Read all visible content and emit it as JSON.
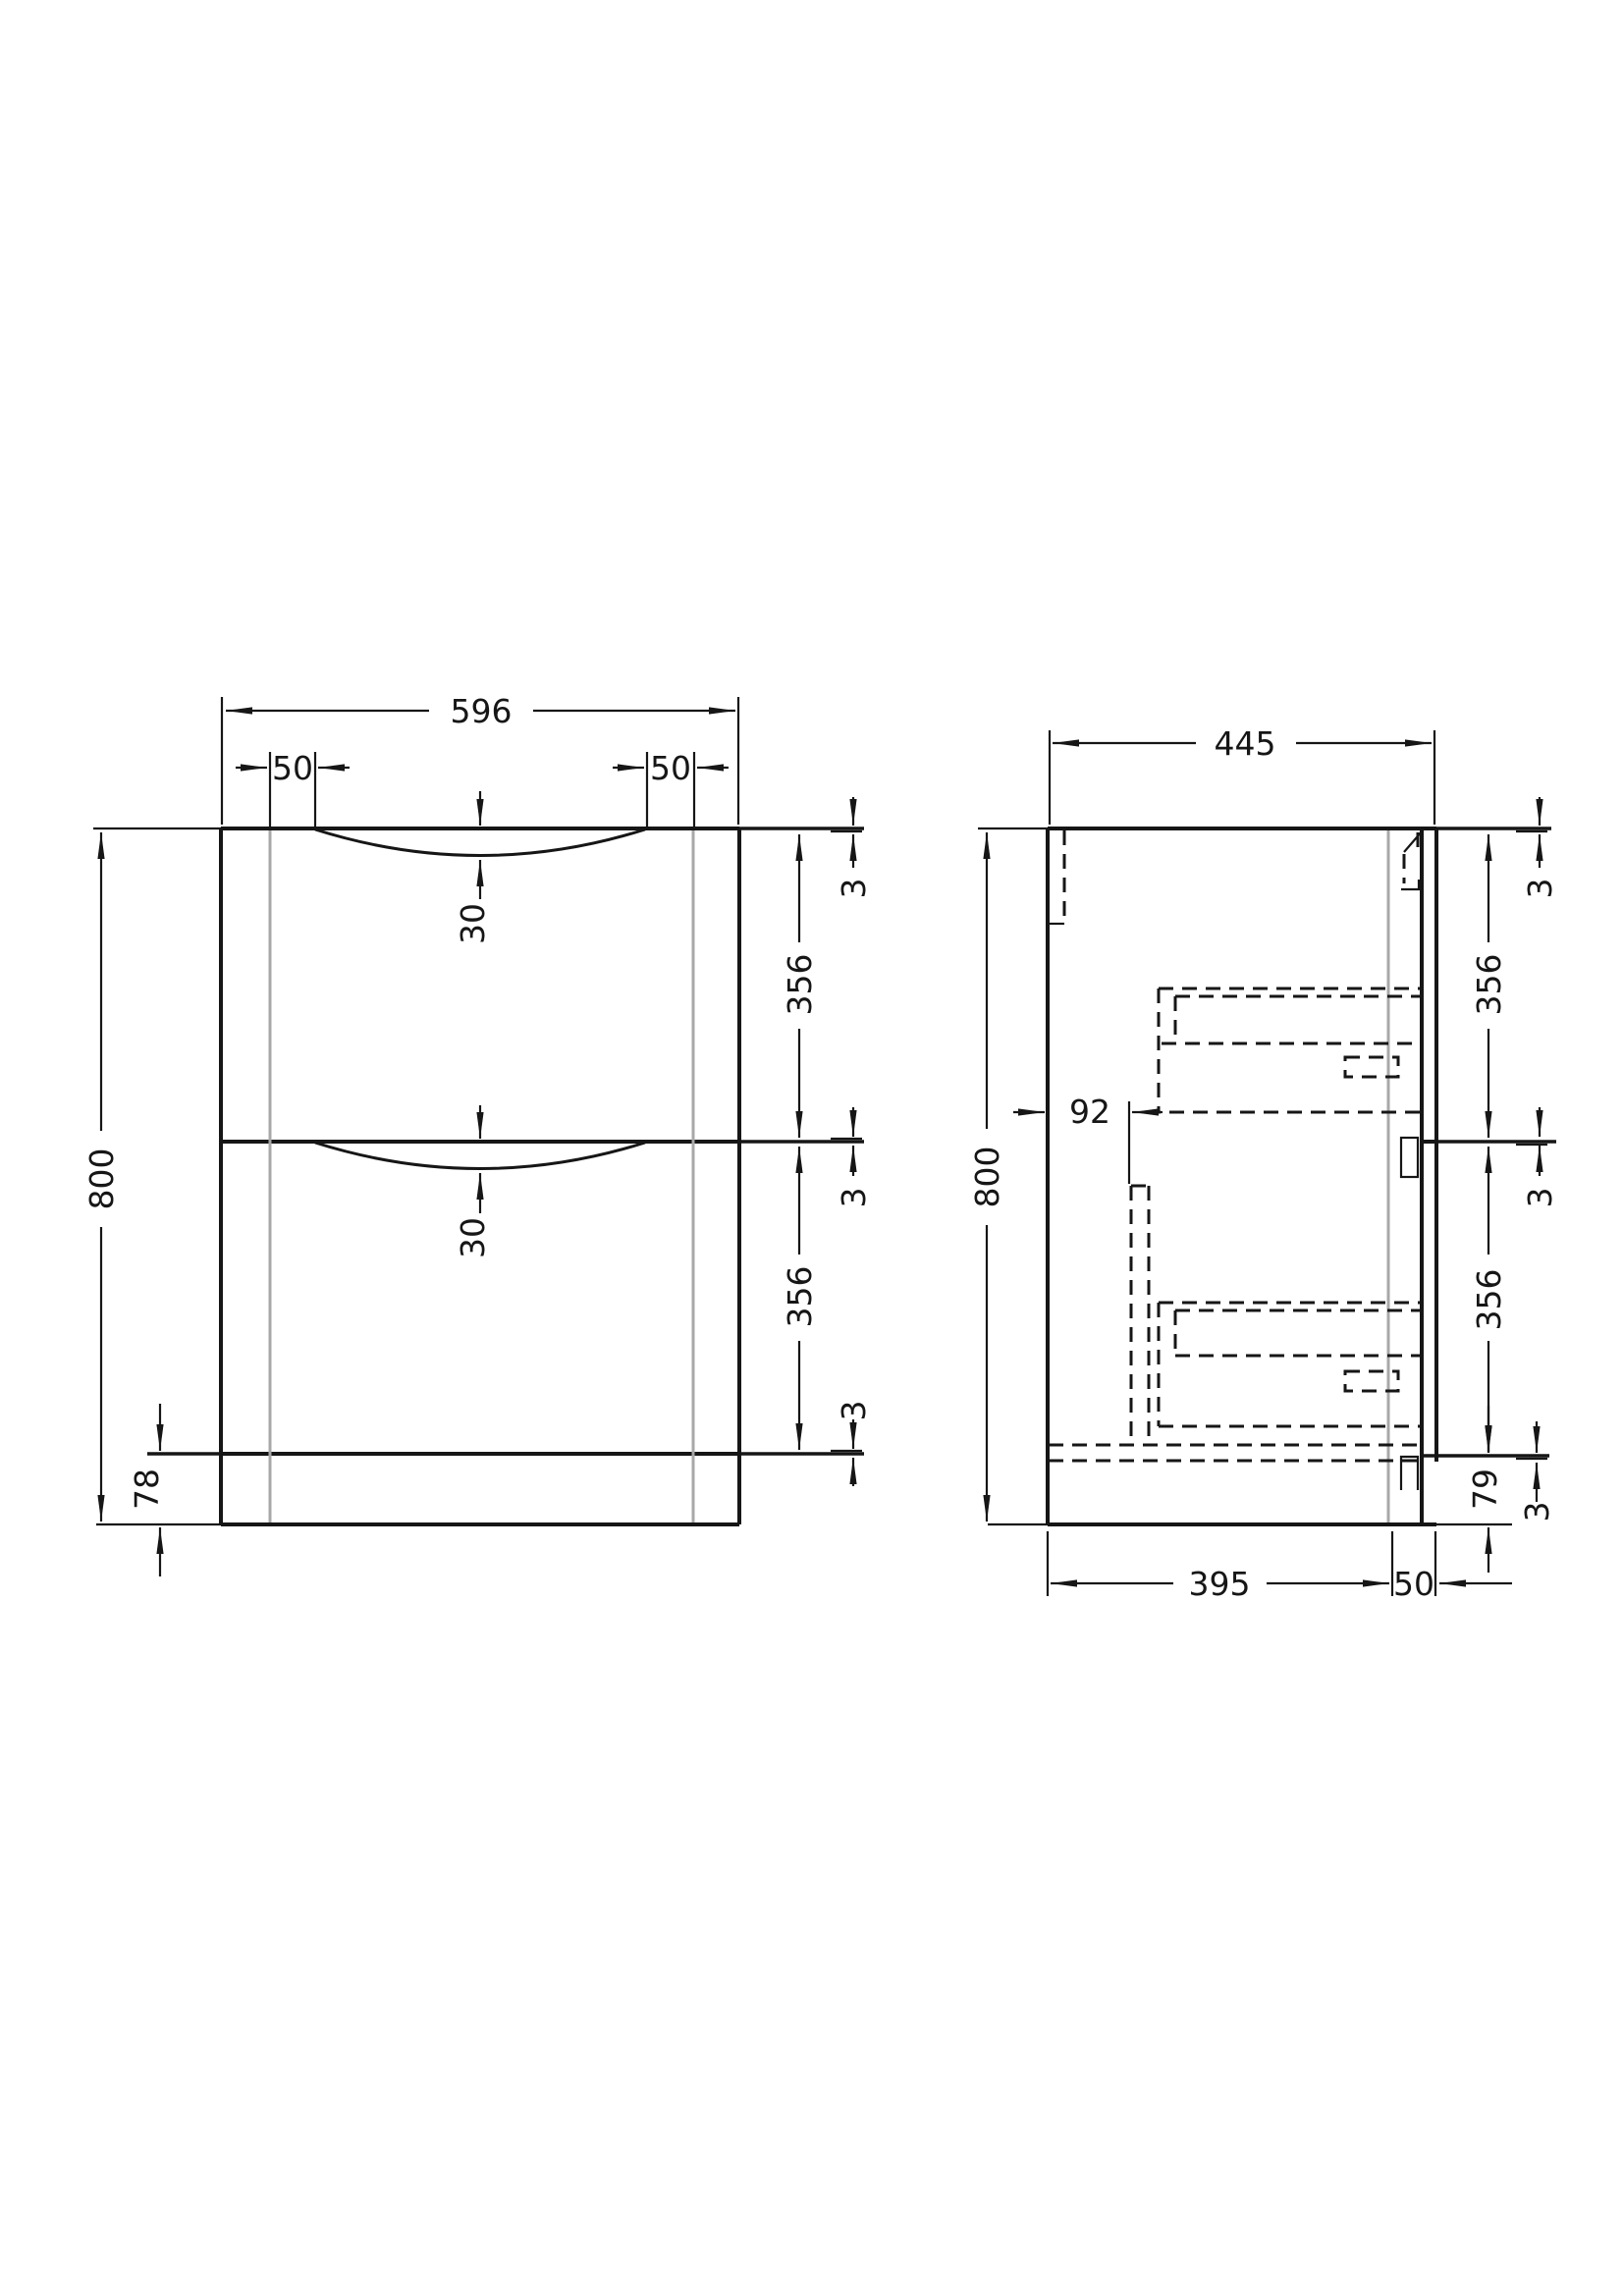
{
  "drawing": {
    "type": "technical-orthographic-drawing",
    "subject": "two-drawer vanity cabinet unit",
    "views": {
      "left": "front elevation",
      "right": "side section"
    }
  },
  "front_view": {
    "overall_width": "596",
    "handle_inset_left": "50",
    "handle_inset_right": "50",
    "overall_height": "800",
    "plinth_height": "78",
    "handle_recess_top": "30",
    "handle_recess_bottom": "30",
    "gap_top": "3",
    "drawer_front_top": "356",
    "gap_middle": "3",
    "drawer_front_bottom": "356",
    "gap_bottom": "3"
  },
  "side_view": {
    "overall_depth": "445",
    "overall_height": "800",
    "drawer_back_offset": "92",
    "gap_top": "3",
    "drawer_front_top": "356",
    "gap_middle": "3",
    "drawer_front_bottom": "356",
    "gap_bottom": "3",
    "plinth_height": "79",
    "base_depth": "395",
    "toe_recess_depth": "50"
  },
  "colors": {
    "line": "#161616",
    "guide_gray": "#a8a8a8",
    "background": "#ffffff"
  }
}
